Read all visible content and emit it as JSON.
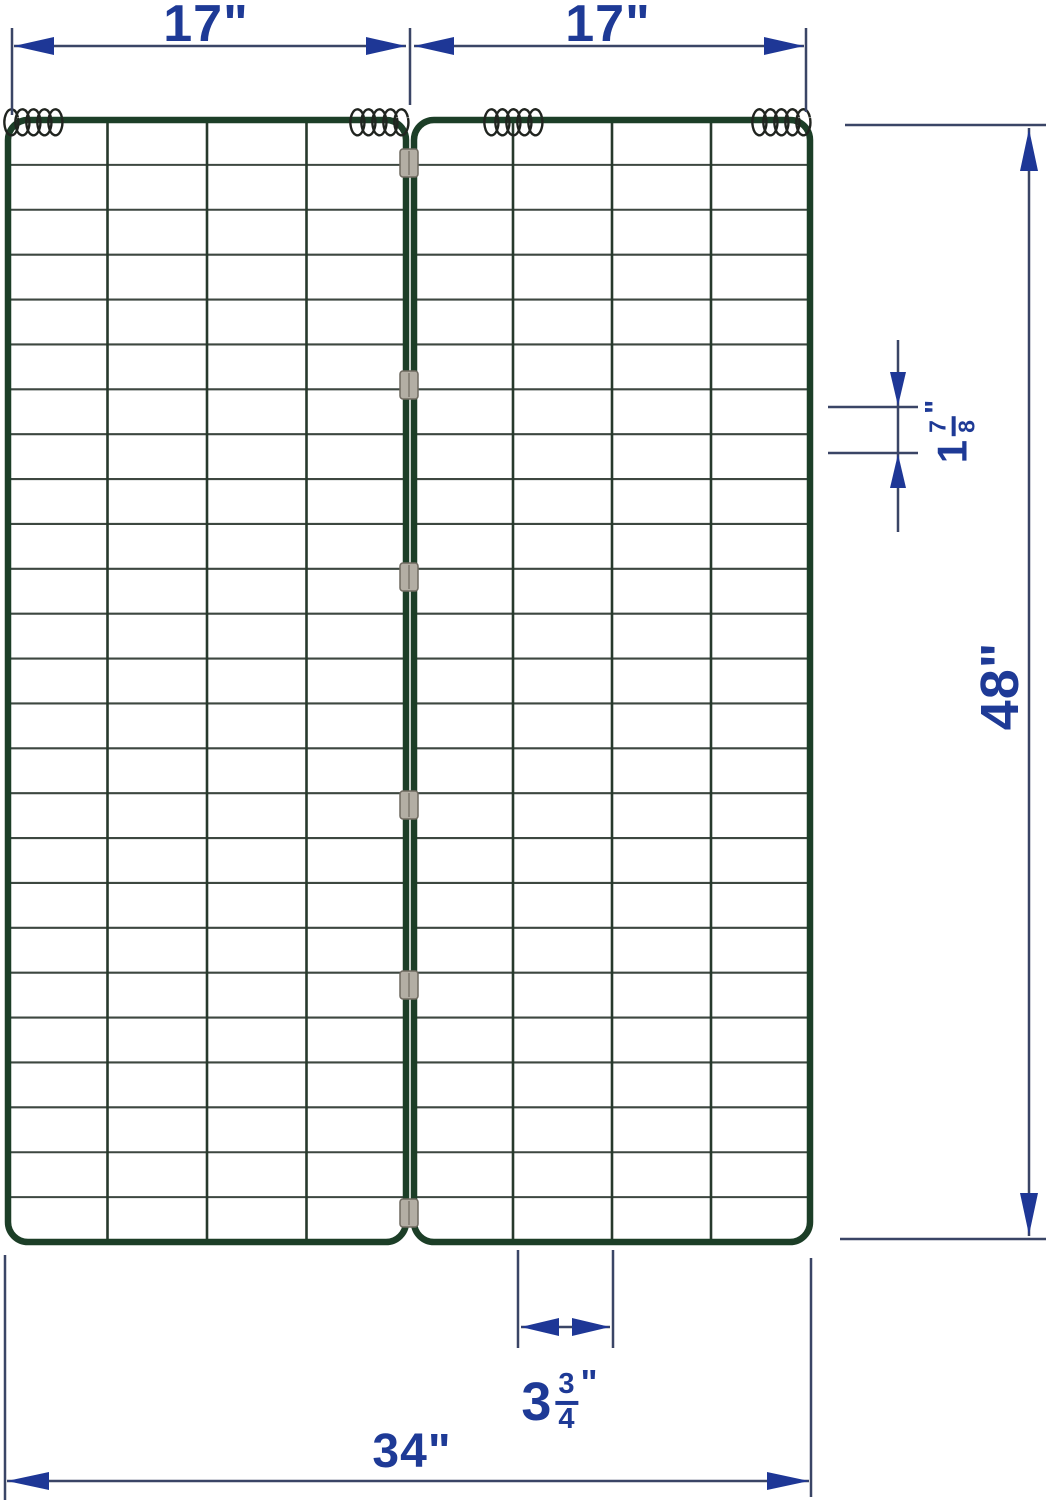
{
  "diagram_title": "folding-wire-trellis-panel-dimensions",
  "colors": {
    "background": "#ffffff",
    "frame_green": "#1c3e27",
    "wire_vertical": "#27392c",
    "wire_horizontal": "#3d4740",
    "spring_black": "#20241f",
    "clip_gray": "#b3aea4",
    "clip_border": "#6f6a60",
    "dim_line": "#3a4566",
    "dim_arrow": "#1e3796",
    "dim_text": "#1e3a96"
  },
  "dimensions": {
    "panel_width_left": {
      "text": "17\""
    },
    "panel_width_right": {
      "text": "17\""
    },
    "total_height": {
      "text": "48\""
    },
    "total_width": {
      "text": "34\""
    },
    "cell_height": {
      "whole": "1",
      "numerator": "7",
      "denominator": "8",
      "unit": "\""
    },
    "cell_width": {
      "whole": "3",
      "numerator": "3",
      "denominator": "4",
      "unit": "\""
    }
  },
  "structure": {
    "panels": 2,
    "columns_per_panel": 4,
    "rows": 25,
    "clip_centers_y": [
      163,
      385,
      577,
      805,
      985,
      1213
    ],
    "spring_starts_x": [
      4,
      350,
      484,
      752
    ],
    "springs_count": 4,
    "clips_count": 6
  }
}
